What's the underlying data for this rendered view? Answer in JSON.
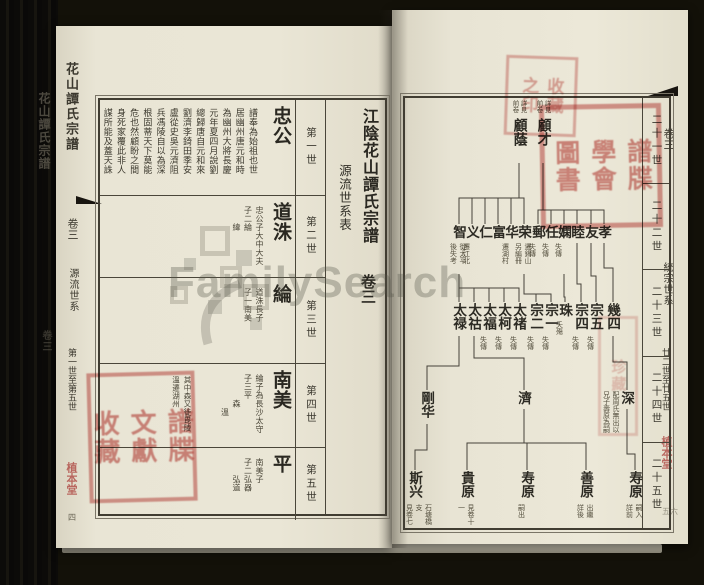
{
  "watermark": {
    "text": "FamilySearch"
  },
  "left_page": {
    "title": "江陰花山譚氏宗譜",
    "subtitle": "源流世系表",
    "volume": "卷三",
    "folio": "四",
    "edge": {
      "book_title": "花山譚氏宗譜",
      "volume": "卷三",
      "section": "源流世系",
      "range": "第一世至第五世",
      "seal_text": "植本堂"
    },
    "rows": [
      {
        "generation": "第一世",
        "name": "忠公",
        "bio": [
          "譜奉為始祖也世",
          "居幽州唐元和時",
          "為幽州大將長慶",
          "元年夏四月說劉",
          "總歸唐自元和來",
          "劉濟李錡田季安",
          "盧從史吳元濟阻",
          "兵馮陵自以為深",
          "根固蒂天下莫能",
          "危也然顧盼之間",
          "身死家覆此非人",
          "謀所能及蓋天誅"
        ]
      },
      {
        "generation": "第二世",
        "name": "道洙",
        "notes": [
          "忠公子大中大夫",
          "子二綸",
          "　　緯"
        ]
      },
      {
        "generation": "第三世",
        "name": "綸",
        "notes": [
          "道洙長子",
          "子一南美"
        ]
      },
      {
        "generation": "第四世",
        "name": "南美",
        "notes": [
          "綸子為長沙太守",
          "子三平",
          "　　　森",
          "　　　　溫"
        ],
        "extra": [
          "其中森又徙毘陵",
          "溫遷湖州"
        ]
      },
      {
        "generation": "第五世",
        "name": "平",
        "notes": [
          "南美子",
          "子二弘器",
          "　　弘道"
        ]
      }
    ]
  },
  "right_page": {
    "generations": [
      "二十一世",
      "二十二世",
      "二十三世",
      "二十四世",
      "二十五世"
    ],
    "edge": {
      "volume": "卷三",
      "section": "統宗世系",
      "range": "廿二世至廿五世",
      "seal_text": "植本堂",
      "folio": "五六"
    },
    "tree": {
      "nodes": [
        {
          "id": "guyin",
          "label": "顧蔭",
          "x": 114,
          "y": 20,
          "h": 42,
          "np": "a",
          "notes": [
            "詳見",
            "前卷"
          ]
        },
        {
          "id": "gucai",
          "label": "顧才",
          "x": 138,
          "y": 20,
          "h": 42,
          "np": "a",
          "notes": [
            "詳見",
            "前卷"
          ]
        },
        {
          "id": "zhi",
          "label": "智",
          "x": 54,
          "y": 127,
          "h": 15,
          "notes": [
            "徙太平",
            "後失考"
          ]
        },
        {
          "id": "yi",
          "label": "义",
          "x": 67,
          "y": 127,
          "h": 15,
          "notes": [
            "遷江北"
          ]
        },
        {
          "id": "ren",
          "label": "仁",
          "x": 80,
          "y": 127,
          "h": 15
        },
        {
          "id": "fu",
          "label": "富",
          "x": 93,
          "y": 127,
          "h": 15
        },
        {
          "id": "hua",
          "label": "华",
          "x": 106,
          "y": 127,
          "h": 15,
          "notes": [
            "遷湖村"
          ]
        },
        {
          "id": "rong",
          "label": "荣",
          "x": 119,
          "y": 127,
          "h": 15,
          "notes": [
            "遷錫山",
            "另編冊"
          ]
        },
        {
          "id": "you2",
          "label": "郵",
          "x": 133,
          "y": 127,
          "h": 15,
          "notes": [
            "失傳"
          ]
        },
        {
          "id": "ren2",
          "label": "任",
          "x": 146,
          "y": 127,
          "h": 15,
          "notes": [
            "失傳"
          ]
        },
        {
          "id": "xian",
          "label": "嫻",
          "x": 159,
          "y": 127,
          "h": 15,
          "notes": [
            "失傳"
          ]
        },
        {
          "id": "mu",
          "label": "睦",
          "x": 172,
          "y": 127,
          "h": 15
        },
        {
          "id": "you3",
          "label": "友",
          "x": 186,
          "y": 127,
          "h": 15
        },
        {
          "id": "xiao",
          "label": "孝",
          "x": 199,
          "y": 127,
          "h": 15
        },
        {
          "id": "tailu",
          "label": "太禄",
          "x": 54,
          "y": 205,
          "h": 30
        },
        {
          "id": "taihu",
          "label": "太祜",
          "x": 69,
          "y": 205,
          "h": 30
        },
        {
          "id": "taifu",
          "label": "太福",
          "x": 84,
          "y": 205,
          "h": 30,
          "notes": [
            "失傳"
          ]
        },
        {
          "id": "taike",
          "label": "太柯",
          "x": 99,
          "y": 205,
          "h": 30,
          "notes": [
            "失傳"
          ]
        },
        {
          "id": "taichu",
          "label": "太禇",
          "x": 114,
          "y": 205,
          "h": 30,
          "notes": [
            "失傳"
          ]
        },
        {
          "id": "zonger",
          "label": "宗二",
          "x": 131,
          "y": 205,
          "h": 30,
          "notes": [
            "失傳"
          ]
        },
        {
          "id": "zongyi",
          "label": "宗一",
          "x": 146,
          "y": 205,
          "h": 30,
          "notes": [
            "失傳"
          ]
        },
        {
          "id": "zhu",
          "label": "珠",
          "x": 160,
          "y": 205,
          "h": 15,
          "notes": [
            "夭殤"
          ]
        },
        {
          "id": "zongsi",
          "label": "宗四",
          "x": 176,
          "y": 205,
          "h": 30,
          "notes": [
            "失傳"
          ]
        },
        {
          "id": "zongwu",
          "label": "宗五",
          "x": 191,
          "y": 205,
          "h": 30,
          "notes": [
            "失傳"
          ]
        },
        {
          "id": "jisi",
          "label": "幾四",
          "x": 208,
          "y": 205,
          "h": 30
        },
        {
          "id": "ganghua",
          "label": "剛华",
          "x": 22,
          "y": 293,
          "h": 30
        },
        {
          "id": "ji",
          "label": "濟",
          "x": 119,
          "y": 293,
          "h": 15
        },
        {
          "id": "shen",
          "label": "深",
          "x": 222,
          "y": 293,
          "h": 15,
          "np": "l",
          "notes": [
            "配周氏無出以",
            "兄子壽原為嗣"
          ]
        },
        {
          "id": "sixing",
          "label": "斯兴",
          "x": 10,
          "y": 373,
          "h": 30,
          "notes": [
            "石塘橋支",
            "見卷七"
          ]
        },
        {
          "id": "guiyuan",
          "label": "貴原",
          "x": 62,
          "y": 373,
          "h": 30,
          "notes": [
            "見卷十一"
          ]
        },
        {
          "id": "shouyuan",
          "label": "寿原",
          "x": 122,
          "y": 373,
          "h": 30,
          "notes": [
            "嗣出"
          ]
        },
        {
          "id": "shanyuan",
          "label": "善原",
          "x": 181,
          "y": 373,
          "h": 30,
          "notes": [
            "出繼",
            "詳後"
          ]
        },
        {
          "id": "shouyuan2",
          "label": "寿原",
          "x": 230,
          "y": 373,
          "h": 30,
          "notes": [
            "嗣入",
            "詳前"
          ]
        }
      ],
      "links": [
        {
          "p": "guyin",
          "c": [
            "zhi",
            "yi",
            "ren",
            "fu",
            "hua",
            "rong"
          ],
          "bus": 100
        },
        {
          "p": "gucai",
          "c": [
            "you2",
            "ren2",
            "xian",
            "mu",
            "you3",
            "xiao"
          ],
          "bus": 112
        },
        {
          "p": "zhi",
          "c": [
            "tailu",
            "taihu",
            "taifu",
            "taike",
            "taichu"
          ],
          "bus": 190
        },
        {
          "p": "rong",
          "c": [
            "zonger",
            "zongyi"
          ],
          "bus": 196
        },
        {
          "p": "xian",
          "c": [
            "zhu"
          ],
          "bus": 199
        },
        {
          "p": "mu",
          "c": [
            "zongsi"
          ],
          "bus": 186
        },
        {
          "p": "you3",
          "c": [
            "zongwu"
          ],
          "bus": 178
        },
        {
          "p": "xiao",
          "c": [
            "jisi"
          ],
          "bus": 170
        },
        {
          "p": "tailu",
          "c": [
            "ganghua"
          ],
          "bus": 268
        },
        {
          "p": "taihu",
          "c": [
            "ji"
          ],
          "bus": 260
        },
        {
          "p": "jisi",
          "c": [
            "shen"
          ],
          "bus": 264
        },
        {
          "p": "ganghua",
          "c": [
            "sixing"
          ],
          "bus": 352
        },
        {
          "p": "ji",
          "c": [
            "guiyuan",
            "shouyuan",
            "shanyuan"
          ],
          "bus": 345
        },
        {
          "p": "shen",
          "c": [
            "shouyuan2"
          ],
          "bus": 356
        }
      ]
    }
  },
  "spine": {
    "title": "花山譚氏宗譜",
    "volume": "卷三"
  },
  "seals": [
    {
      "id": "left-bottom",
      "cols": [
        "譜牒",
        "文獻",
        "收藏"
      ]
    },
    {
      "id": "right-top-small",
      "cols": [
        "收藏",
        "之印"
      ]
    },
    {
      "id": "right-top-big",
      "cols": [
        "譜牒",
        "學會",
        "圖書"
      ]
    },
    {
      "id": "right-mid",
      "cols": [
        "珍藏"
      ]
    }
  ]
}
